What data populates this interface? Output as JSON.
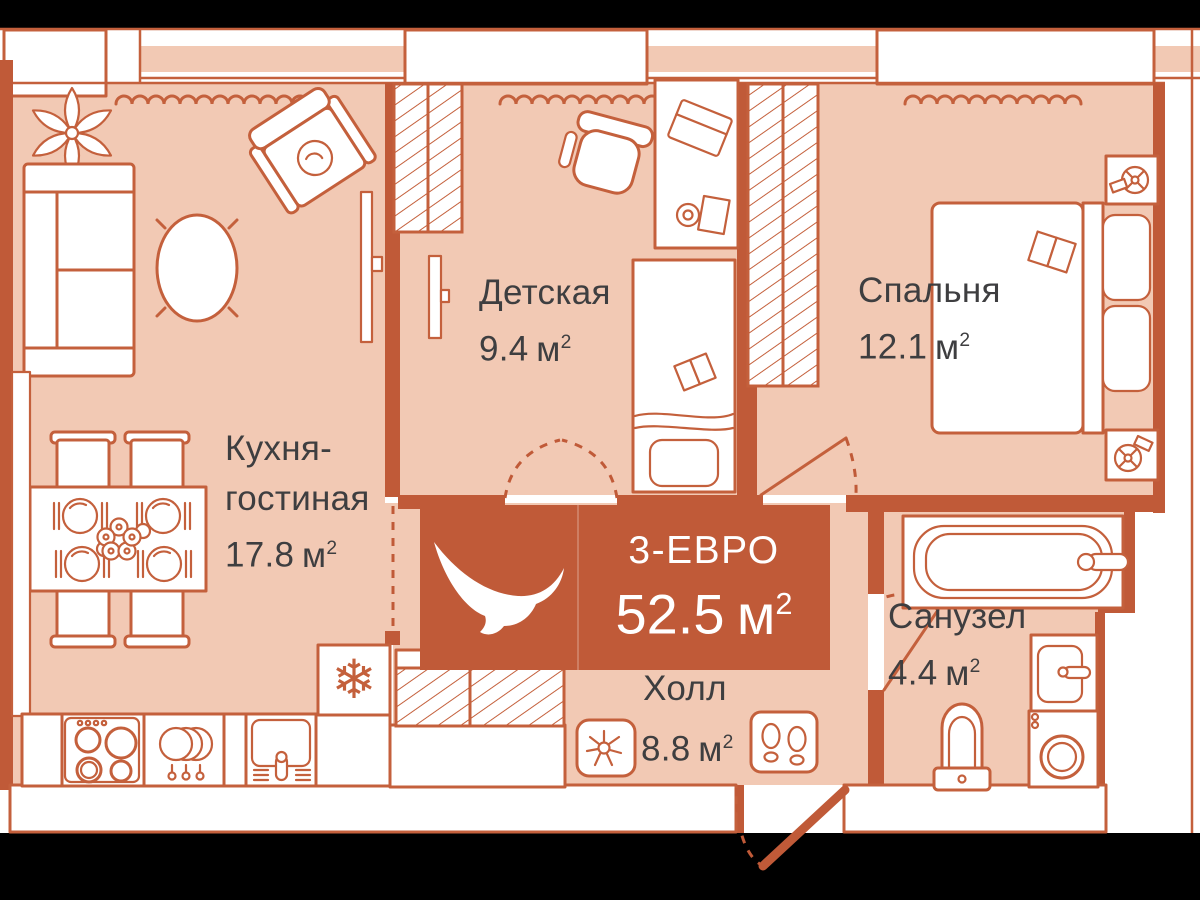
{
  "palette": {
    "wall_orange": "#c05a38",
    "line_orange": "#c4603c",
    "floor_peach": "#f2c9b4",
    "label_text": "#3e3e40",
    "backdrop": "#000000",
    "furniture_white": "#ffffff"
  },
  "units": {
    "unit": "м",
    "sup": "2"
  },
  "badge": {
    "layout_type": "3-ЕВРО",
    "total_area": "52.5"
  },
  "rooms": [
    {
      "key": "kitchen-living",
      "name_lines": [
        "Кухня-",
        "гостиная"
      ],
      "area": "17.8"
    },
    {
      "key": "nursery",
      "name_lines": [
        "Детская"
      ],
      "area": "9.4"
    },
    {
      "key": "bedroom",
      "name_lines": [
        "Спальня"
      ],
      "area": "12.1"
    },
    {
      "key": "bathroom",
      "name_lines": [
        "Санузел"
      ],
      "area": "4.4"
    },
    {
      "key": "hall",
      "name_lines": [
        "Холл"
      ],
      "area": "8.8"
    }
  ],
  "icons": {
    "snowflake": "❄"
  }
}
